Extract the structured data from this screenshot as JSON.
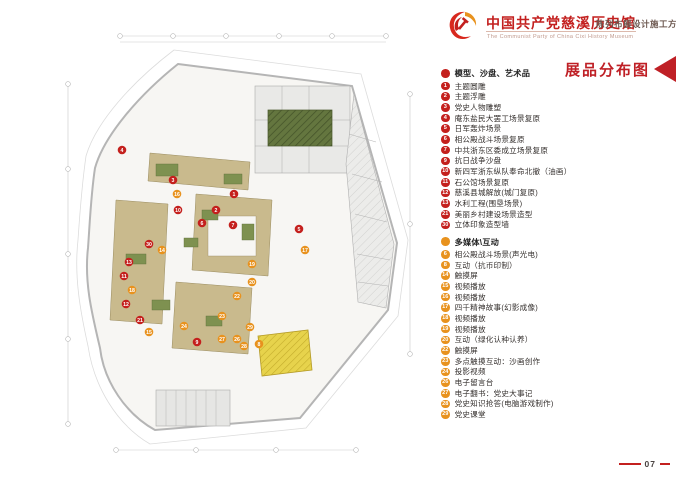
{
  "header": {
    "title": "中国共产党慈溪历史馆",
    "subtitle_en": "The Communist Party of China Cixi  History Museum",
    "doc_type": "陈列布展设计施工方案",
    "logo_icon": "party-emblem-icon"
  },
  "legend": {
    "title": "展品分布图",
    "sections": [
      {
        "name": "模型、沙盘、艺术品",
        "color": "#c4201d",
        "items": [
          {
            "num": "1",
            "label": "主题圆雕"
          },
          {
            "num": "2",
            "label": "主题浮雕"
          },
          {
            "num": "3",
            "label": "党史人物雕塑"
          },
          {
            "num": "4",
            "label": "庵东盐民大罢工场景复原"
          },
          {
            "num": "5",
            "label": "日军轰炸场景"
          },
          {
            "num": "6",
            "label": "相公殿战斗场景复原"
          },
          {
            "num": "7",
            "label": "中共浙东区委成立场景复原"
          },
          {
            "num": "9",
            "label": "抗日战争沙盘"
          },
          {
            "num": "10",
            "label": "新四军浙东纵队奉命北撤（油画）"
          },
          {
            "num": "11",
            "label": "石公馆场景复原"
          },
          {
            "num": "12",
            "label": "慈溪县城解放(城门复原)"
          },
          {
            "num": "13",
            "label": "水利工程(围垦场景)"
          },
          {
            "num": "21",
            "label": "美丽乡村建设场景造型"
          },
          {
            "num": "30",
            "label": "立体印象造型墙"
          }
        ]
      },
      {
        "name": "多媒体\\互动",
        "color": "#e8921e",
        "items": [
          {
            "num": "6",
            "label": "相公殿战斗场景(声光电)"
          },
          {
            "num": "8",
            "label": "互动（抗币印制）"
          },
          {
            "num": "14",
            "label": "触摸屏"
          },
          {
            "num": "15",
            "label": "视频播放"
          },
          {
            "num": "16",
            "label": "视频播放"
          },
          {
            "num": "17",
            "label": "四千精神故事(幻影成像)"
          },
          {
            "num": "18",
            "label": "视频播放"
          },
          {
            "num": "19",
            "label": "视频播放"
          },
          {
            "num": "20",
            "label": "互动（绿化认种认养）"
          },
          {
            "num": "22",
            "label": "触摸屏"
          },
          {
            "num": "23",
            "label": "多点触摸互动：沙画创作"
          },
          {
            "num": "24",
            "label": "投影视频"
          },
          {
            "num": "26",
            "label": "电子留言台"
          },
          {
            "num": "27",
            "label": "电子翻书：党史大事记"
          },
          {
            "num": "28",
            "label": "党史知识抢答(电脑游戏制作)"
          },
          {
            "num": "29",
            "label": "党史课堂"
          }
        ]
      }
    ]
  },
  "page_number": "07",
  "plan": {
    "colors": {
      "red_marker": "#c4201d",
      "orange_marker": "#e8921e",
      "tan_wall": "#c9ba8d",
      "green_block": "#7e9150",
      "dark_hatch": "#64763f",
      "yellow_room": "#e7d34c",
      "gray_room": "#e9e9e7",
      "outline": "#b5b5b5"
    },
    "markers": [
      {
        "num": "1",
        "type": "red",
        "x": 178,
        "y": 170
      },
      {
        "num": "2",
        "type": "red",
        "x": 160,
        "y": 186
      },
      {
        "num": "3",
        "type": "red",
        "x": 117,
        "y": 156
      },
      {
        "num": "4",
        "type": "red",
        "x": 66,
        "y": 126
      },
      {
        "num": "5",
        "type": "red",
        "x": 243,
        "y": 205
      },
      {
        "num": "6",
        "type": "red",
        "x": 146,
        "y": 199
      },
      {
        "num": "7",
        "type": "red",
        "x": 177,
        "y": 201
      },
      {
        "num": "9",
        "type": "red",
        "x": 141,
        "y": 318
      },
      {
        "num": "10",
        "type": "red",
        "x": 122,
        "y": 186
      },
      {
        "num": "11",
        "type": "red",
        "x": 68,
        "y": 252
      },
      {
        "num": "12",
        "type": "red",
        "x": 70,
        "y": 280
      },
      {
        "num": "13",
        "type": "red",
        "x": 73,
        "y": 238
      },
      {
        "num": "21",
        "type": "red",
        "x": 84,
        "y": 296
      },
      {
        "num": "30",
        "type": "red",
        "x": 93,
        "y": 220
      },
      {
        "num": "8",
        "type": "orange",
        "x": 203,
        "y": 320
      },
      {
        "num": "14",
        "type": "orange",
        "x": 106,
        "y": 226
      },
      {
        "num": "15",
        "type": "orange",
        "x": 93,
        "y": 308
      },
      {
        "num": "16",
        "type": "orange",
        "x": 121,
        "y": 170
      },
      {
        "num": "17",
        "type": "orange",
        "x": 249,
        "y": 226
      },
      {
        "num": "18",
        "type": "orange",
        "x": 76,
        "y": 266
      },
      {
        "num": "19",
        "type": "orange",
        "x": 196,
        "y": 240
      },
      {
        "num": "20",
        "type": "orange",
        "x": 196,
        "y": 258
      },
      {
        "num": "22",
        "type": "orange",
        "x": 181,
        "y": 272
      },
      {
        "num": "23",
        "type": "orange",
        "x": 166,
        "y": 292
      },
      {
        "num": "24",
        "type": "orange",
        "x": 128,
        "y": 302
      },
      {
        "num": "26",
        "type": "orange",
        "x": 181,
        "y": 315
      },
      {
        "num": "27",
        "type": "orange",
        "x": 166,
        "y": 315
      },
      {
        "num": "28",
        "type": "orange",
        "x": 188,
        "y": 322
      },
      {
        "num": "29",
        "type": "orange",
        "x": 194,
        "y": 303
      }
    ]
  }
}
